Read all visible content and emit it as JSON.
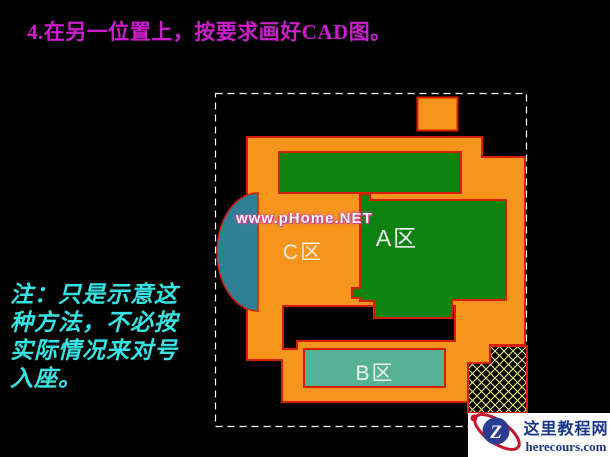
{
  "slide": {
    "title": "4.在另一位置上，按要求画好CAD图。",
    "title_color": "#cc1ecc",
    "note_lines": [
      "注：只是示意这",
      "种方法，不必按",
      "实际情况来对号",
      "入座。"
    ],
    "note_color": "#36e3e3",
    "watermark": "www.pHome.NET",
    "watermark_color": "#f5f5f5"
  },
  "drawing": {
    "labels": {
      "area_a": "A区",
      "area_b": "B区",
      "area_c": "C区"
    },
    "colors": {
      "wall_orange": "#f6941d",
      "region_green": "#0e820e",
      "region_teal": "#55b294",
      "ellipse_blue": "#2f7f96",
      "boundary_red": "#d81e00",
      "hatch_yellow": "#ecec8c",
      "marquee_white": "#ffffff",
      "label_white": "#f2f2f2",
      "label_cream": "#eeeedc"
    }
  },
  "logo": {
    "site_name": "这里教程网",
    "site_url": "herecours.com",
    "monogram": "Z",
    "brand_blue": "#2b3d92",
    "brand_red": "#c5152f",
    "text_color": "#19368c"
  }
}
